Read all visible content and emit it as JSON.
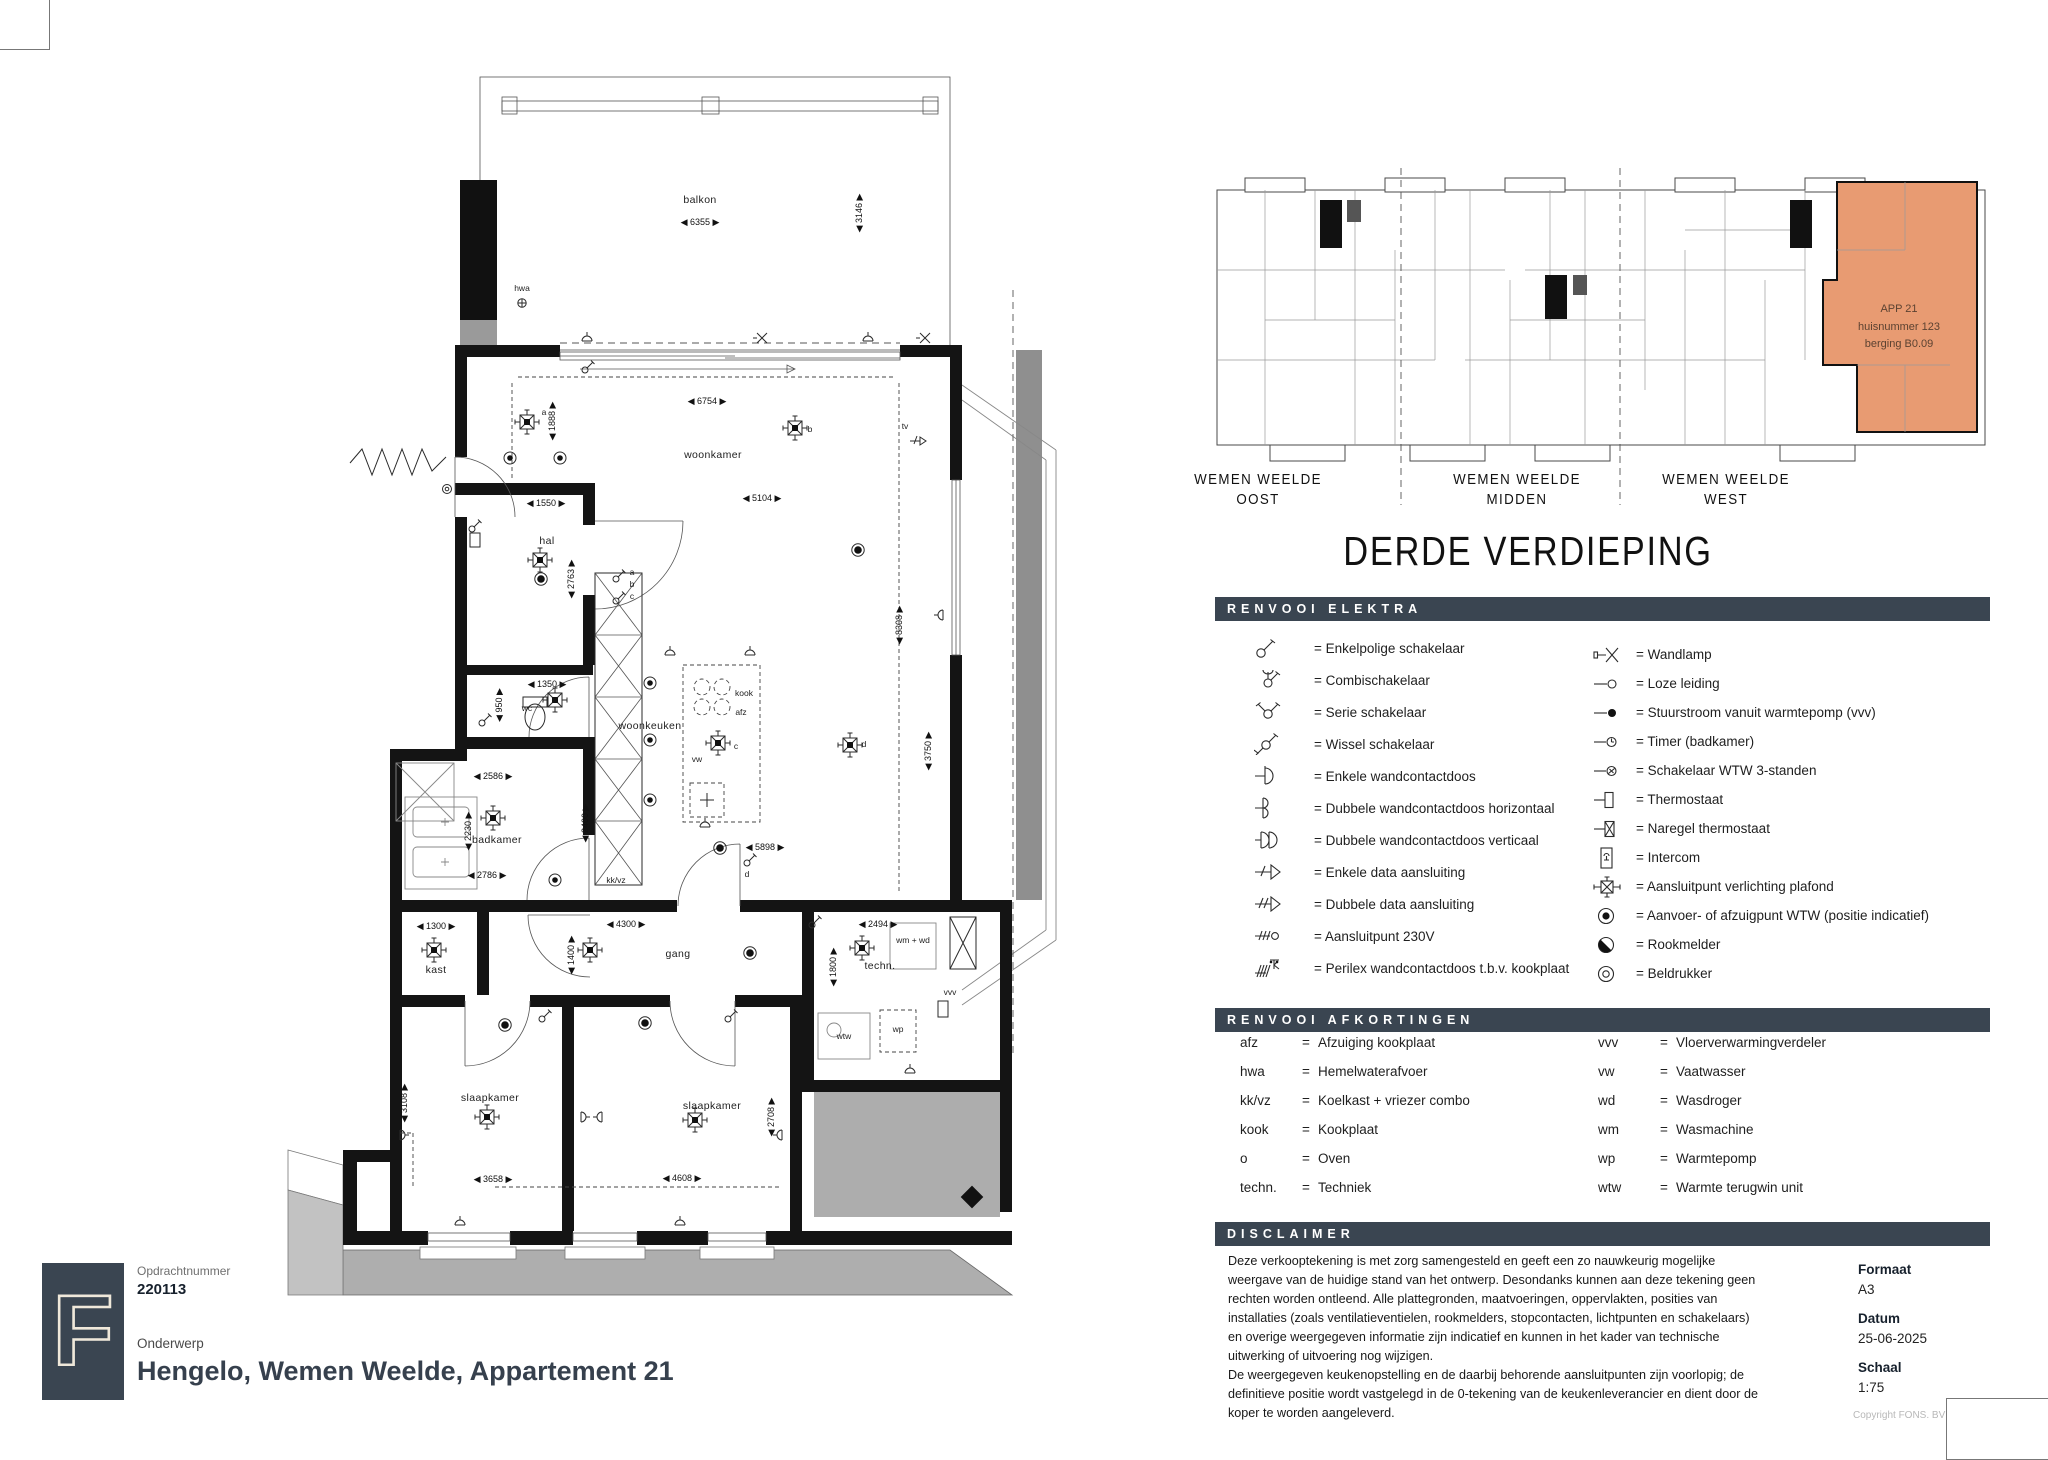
{
  "titleblock": {
    "logo_letter": "F",
    "opdrachtnummer_label": "Opdrachtnummer",
    "opdrachtnummer": "220113",
    "onderwerp_label": "Onderwerp",
    "onderwerp": "Hengelo, Wemen Weelde, Appartement 21"
  },
  "meta": {
    "formaat_label": "Formaat",
    "formaat": "A3",
    "datum_label": "Datum",
    "datum": "25-06-2025",
    "schaal_label": "Schaal",
    "schaal": "1:75",
    "copyright": "Copyright FONS. BV"
  },
  "overview": {
    "title": "DERDE VERDIEPING",
    "sections": [
      {
        "line1": "WEMEN WEELDE",
        "line2": "OOST"
      },
      {
        "line1": "WEMEN WEELDE",
        "line2": "MIDDEN"
      },
      {
        "line1": "WEMEN WEELDE",
        "line2": "WEST"
      }
    ],
    "highlight": {
      "color": "#E89B72",
      "lines": [
        {
          "t": "APP 21",
          "x": 694,
          "y": 152
        },
        {
          "t": "huisnummer 123",
          "x": 694,
          "y": 170
        },
        {
          "t": "berging B0.09",
          "x": 694,
          "y": 187
        }
      ]
    }
  },
  "legend_elektra": {
    "header": "RENVOOI ELEKTRA",
    "left": [
      {
        "sym": "enkelpolig",
        "label": "Enkelpolige schakelaar"
      },
      {
        "sym": "combi",
        "label": "Combischakelaar"
      },
      {
        "sym": "serie",
        "label": "Serie schakelaar"
      },
      {
        "sym": "wissel",
        "label": "Wissel schakelaar"
      },
      {
        "sym": "wcd1",
        "label": "Enkele wandcontactdoos"
      },
      {
        "sym": "wcd2h",
        "label": "Dubbele wandcontactdoos horizontaal"
      },
      {
        "sym": "wcd2v",
        "label": "Dubbele wandcontactdoos verticaal"
      },
      {
        "sym": "data1",
        "label": "Enkele data aansluiting"
      },
      {
        "sym": "data2",
        "label": "Dubbele data aansluiting"
      },
      {
        "sym": "v230",
        "label": "Aansluitpunt 230V"
      },
      {
        "sym": "perilex",
        "label": "Perilex wandcontactdoos t.b.v. kookplaat"
      }
    ],
    "right": [
      {
        "sym": "wandlamp",
        "label": "Wandlamp"
      },
      {
        "sym": "loze",
        "label": "Loze leiding"
      },
      {
        "sym": "stuur",
        "label": "Stuurstroom vanuit warmtepomp (vvv)"
      },
      {
        "sym": "timer",
        "label": "Timer (badkamer)"
      },
      {
        "sym": "wtw3",
        "label": "Schakelaar WTW 3-standen"
      },
      {
        "sym": "thermo",
        "label": "Thermostaat"
      },
      {
        "sym": "naregel",
        "label": "Naregel thermostaat"
      },
      {
        "sym": "intercom",
        "label": "Intercom"
      },
      {
        "sym": "plafond",
        "label": "Aansluitpunt verlichting plafond"
      },
      {
        "sym": "wtwpunt",
        "label": "Aanvoer- of afzuigpunt WTW (positie indicatief)"
      },
      {
        "sym": "rook",
        "label": "Rookmelder"
      },
      {
        "sym": "bel",
        "label": "Beldrukker"
      }
    ]
  },
  "legend_afkortingen": {
    "header": "RENVOOI AFKORTINGEN",
    "left": [
      {
        "abbr": "afz",
        "term": "Afzuiging kookplaat"
      },
      {
        "abbr": "hwa",
        "term": "Hemelwaterafvoer"
      },
      {
        "abbr": "kk/vz",
        "term": "Koelkast + vriezer combo"
      },
      {
        "abbr": "kook",
        "term": "Kookplaat"
      },
      {
        "abbr": "o",
        "term": "Oven"
      },
      {
        "abbr": "techn.",
        "term": "Techniek"
      }
    ],
    "right": [
      {
        "abbr": "vvv",
        "term": "Vloerverwarmingverdeler"
      },
      {
        "abbr": "vw",
        "term": "Vaatwasser"
      },
      {
        "abbr": "wd",
        "term": "Wasdroger"
      },
      {
        "abbr": "wm",
        "term": "Wasmachine"
      },
      {
        "abbr": "wp",
        "term": "Warmtepomp"
      },
      {
        "abbr": "wtw",
        "term": "Warmte terugwin unit"
      }
    ]
  },
  "disclaimer": {
    "header": "DISCLAIMER",
    "text": "Deze verkooptekening is met zorg samengesteld en geeft een zo nauwkeurig mogelijke\nweergave van de huidige stand van het ontwerp. Desondanks kunnen aan deze tekening geen\nrechten worden ontleend. Alle plattegronden, maatvoeringen, oppervlakten, posities van\ninstallaties (zoals ventilatieventielen, rookmelders, stopcontacten, lichtpunten en schakelaars)\nen overige weergegeven informatie zijn indicatief en kunnen in het kader van technische\nuitwerking of uitvoering nog wijzigen.\nDe weergegeven keukenopstelling en de daarbij behorende aansluitpunten zijn voorlopig; de\ndefinitieve positie wordt vastgelegd in de 0-tekening van de keukenleverancier en dient door de\nkoper te worden aangeleverd."
  },
  "floorplan": {
    "texts": [
      {
        "t": "balkon",
        "x": 450,
        "y": 148,
        "k": "room"
      },
      {
        "t": "6355",
        "x": 450,
        "y": 170,
        "k": "dh"
      },
      {
        "t": "3146",
        "x": 612,
        "y": 158,
        "k": "dv"
      },
      {
        "t": "hwa",
        "x": 272,
        "y": 236,
        "k": "tag"
      },
      {
        "t": "woonkamer",
        "x": 463,
        "y": 403,
        "k": "room"
      },
      {
        "t": "6754",
        "x": 457,
        "y": 349,
        "k": "dh"
      },
      {
        "t": "5104",
        "x": 512,
        "y": 446,
        "k": "dh"
      },
      {
        "t": "1888",
        "x": 305,
        "y": 366,
        "k": "dv"
      },
      {
        "t": "a",
        "x": 294,
        "y": 360,
        "k": "tag"
      },
      {
        "t": "b",
        "x": 560,
        "y": 377,
        "k": "tag"
      },
      {
        "t": "tv",
        "x": 655,
        "y": 374,
        "k": "tag"
      },
      {
        "t": "8308",
        "x": 652,
        "y": 570,
        "k": "dv"
      },
      {
        "t": "hal",
        "x": 297,
        "y": 489,
        "k": "room"
      },
      {
        "t": "1550",
        "x": 296,
        "y": 451,
        "k": "dh"
      },
      {
        "t": "2763",
        "x": 324,
        "y": 524,
        "k": "dv"
      },
      {
        "t": "a",
        "x": 382,
        "y": 520,
        "k": "tag"
      },
      {
        "t": "b",
        "x": 382,
        "y": 532,
        "k": "tag"
      },
      {
        "t": "c",
        "x": 382,
        "y": 544,
        "k": "tag"
      },
      {
        "t": "wc",
        "x": 277,
        "y": 656,
        "k": "tag"
      },
      {
        "t": "950",
        "x": 252,
        "y": 650,
        "k": "dv"
      },
      {
        "t": "1350",
        "x": 297,
        "y": 632,
        "k": "dh"
      },
      {
        "t": "badkamer",
        "x": 247,
        "y": 788,
        "k": "room"
      },
      {
        "t": "2586",
        "x": 243,
        "y": 724,
        "k": "dh"
      },
      {
        "t": "2230",
        "x": 221,
        "y": 776,
        "k": "dv"
      },
      {
        "t": "2786",
        "x": 237,
        "y": 823,
        "k": "dh"
      },
      {
        "t": "2400",
        "x": 338,
        "y": 768,
        "k": "dv"
      },
      {
        "t": "kk/vz",
        "x": 366,
        "y": 828,
        "k": "tag"
      },
      {
        "t": "woonkeuken",
        "x": 400,
        "y": 674,
        "k": "room"
      },
      {
        "t": "kook",
        "x": 494,
        "y": 641,
        "k": "tag"
      },
      {
        "t": "afz",
        "x": 491,
        "y": 660,
        "k": "tag"
      },
      {
        "t": "c",
        "x": 486,
        "y": 694,
        "k": "tag"
      },
      {
        "t": "vw",
        "x": 447,
        "y": 707,
        "k": "tag"
      },
      {
        "t": "d",
        "x": 614,
        "y": 692,
        "k": "tag"
      },
      {
        "t": "5898",
        "x": 515,
        "y": 795,
        "k": "dh"
      },
      {
        "t": "d",
        "x": 497,
        "y": 822,
        "k": "tag"
      },
      {
        "t": "3750",
        "x": 681,
        "y": 696,
        "k": "dv"
      },
      {
        "t": "kast",
        "x": 186,
        "y": 918,
        "k": "room"
      },
      {
        "t": "1300",
        "x": 186,
        "y": 874,
        "k": "dh"
      },
      {
        "t": "gang",
        "x": 428,
        "y": 902,
        "k": "room"
      },
      {
        "t": "4300",
        "x": 376,
        "y": 872,
        "k": "dh"
      },
      {
        "t": "1400",
        "x": 324,
        "y": 900,
        "k": "dv"
      },
      {
        "t": "techn.",
        "x": 630,
        "y": 914,
        "k": "room"
      },
      {
        "t": "2494",
        "x": 628,
        "y": 872,
        "k": "dh"
      },
      {
        "t": "1800",
        "x": 586,
        "y": 912,
        "k": "dv"
      },
      {
        "t": "wm + wd",
        "x": 663,
        "y": 888,
        "k": "tag"
      },
      {
        "t": "wtw",
        "x": 594,
        "y": 984,
        "k": "tag"
      },
      {
        "t": "wp",
        "x": 648,
        "y": 977,
        "k": "tag"
      },
      {
        "t": "vvv",
        "x": 700,
        "y": 940,
        "k": "tag"
      },
      {
        "t": "slaapkamer",
        "x": 240,
        "y": 1046,
        "k": "room"
      },
      {
        "t": "3108",
        "x": 157,
        "y": 1048,
        "k": "dv"
      },
      {
        "t": "3658",
        "x": 243,
        "y": 1127,
        "k": "dh"
      },
      {
        "t": "slaapkamer",
        "x": 462,
        "y": 1054,
        "k": "room"
      },
      {
        "t": "2708",
        "x": 524,
        "y": 1062,
        "k": "dv"
      },
      {
        "t": "4608",
        "x": 432,
        "y": 1126,
        "k": "dh"
      }
    ]
  }
}
